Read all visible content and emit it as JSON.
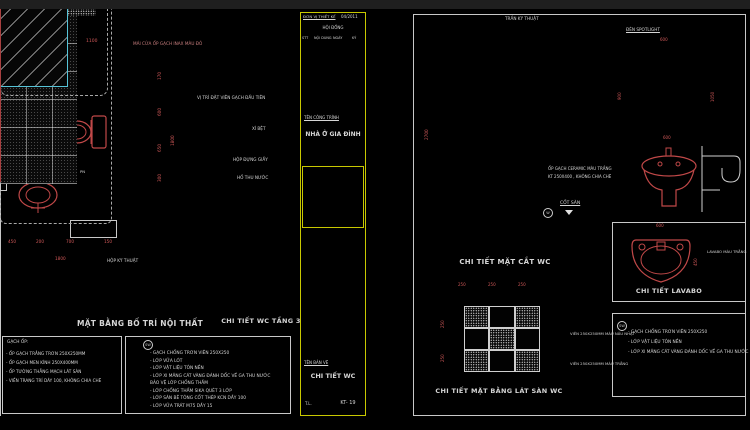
{
  "palette": {
    "line_white": "#c8c8c8",
    "dim_red": "#d05858",
    "accent_yellow": "#c8c800",
    "accent_cyan": "#56c4d8",
    "bg": "#000000"
  },
  "left_sheet": {
    "plan_title": "MẶT BẰNG BỐ TRÍ NỘI THẤT",
    "detail_title": "CHI TIẾT WC TẦNG 3",
    "top_note": "MÁI CỬA ỐP GẠCH INAX MÀU ĐỎ",
    "room": {
      "name": "WC",
      "area": "( 2.5 M2 )",
      "level": "+0.000",
      "drain_mark": "PN"
    },
    "callouts": {
      "first_tile": "VỊ TRÍ ĐẶT VIÊN GẠCH ĐẦU TIÊN",
      "toilet": "XÍ BỆT",
      "paper_box": "HỘP ĐỰNG GIẤY",
      "drain": "HỐ THU NƯỚC",
      "tech_box": "HỘP KỸ THUẬT"
    },
    "dims": {
      "top": [
        "300",
        "700",
        "1100"
      ],
      "right": [
        "170",
        "600",
        "650",
        "300"
      ],
      "right_total": "1800",
      "bottom": [
        "450",
        "200",
        "700",
        "150"
      ],
      "bottom_total": "1800"
    },
    "notes_finish": {
      "heading": "GẠCH ỐP:",
      "lines": [
        "- ỐP GẠCH TRẮNG TRƠN 250X250MM",
        "- ỐP GẠCH MEN KÍNH 250X400MM",
        "- ỐP TƯỜNG THẲNG MẠCH LÁT SÀN",
        "- VIỀN TRANG TRÍ DÀY 100, KHÔNG CHIA CHẼ"
      ]
    },
    "notes_floor": {
      "symbol": "SW",
      "lines": [
        "- GẠCH CHỐNG TRƠN VIÊN 250X250",
        "- LỚP VỮA LÓT",
        "- LỚP VẬT LIỆU TÔN NỀN",
        "- LỚP XI MĂNG CÁT VÀNG ĐÁNH DỐC VỀ GA THU NƯỚC",
        "  BẢO VỆ LỚP CHỐNG THẤM",
        "- LỚP CHỐNG THẤM SIKA QUÉT 3 LỚP",
        "- LỚP SÀN BÊ TÔNG CỐT THÉP KCN DẦY 100",
        "- LỚP VỮA TRÁT M75 DẦY 15"
      ]
    }
  },
  "title_block": {
    "firm_label": "ĐƠN VỊ THIẾT KẾ",
    "date": "04/2011",
    "council": "HỘI ĐỒNG",
    "cols": [
      "STT",
      "NỘI DUNG",
      "NGÀY",
      "KÝ"
    ],
    "project_label": "TÊN CÔNG TRÌNH",
    "project_name": "NHÀ Ở GIA ĐÌNH",
    "drawing_label": "TÊN BẢN VẼ",
    "drawing_name": "CHI TIẾT WC",
    "scale": "T.L.",
    "sheet_no": "KT- 19"
  },
  "right_sheet": {
    "section": {
      "title": "CHI TIẾT MẶT CẮT WC",
      "ceiling": "TRẦN KỸ THUẬT",
      "tile_note_1": "ỐP  GẠCH CERAMIC MÀU TRẮNG",
      "tile_note_2": "KT 250X400 , KHÔNG CHIA CHẼ",
      "floor_level": "CỐT SÀN",
      "symbol": "W",
      "dim_height": "2700"
    },
    "floor_plan": {
      "title": "CHI TIẾT MẶT BẰNG LÁT SÀN WC",
      "legend": [
        {
          "label": "VIÊN 250X250MM MÀU NÂU NHẠT"
        },
        {
          "label": "VIÊN 250X250MM MÀU TRẮNG"
        }
      ],
      "dims_top": [
        "250",
        "250",
        "250"
      ],
      "dims_left": [
        "250",
        "250"
      ]
    },
    "mirror": {
      "light": "ĐÈN SPOTLIGHT",
      "dim_left": "900",
      "dim_right": "1050",
      "dim_top": "600"
    },
    "lavabo": {
      "title": "CHI TIẾT LAVABO",
      "label": "LAVABO MÀU TRẮNG",
      "dim_front": "600",
      "dim_top": "600",
      "dim_side": "450"
    },
    "notes": {
      "symbol": "SW",
      "lines": [
        "- GẠCH CHỐNG TRƠN VIÊN 250X250",
        "- LỚP VẬT LIỆU TÔN NỀN",
        "- LỚP XI MĂNG CÁT VÀNG ĐÁNH DỐC VỀ GA THU NƯỚC"
      ]
    }
  }
}
